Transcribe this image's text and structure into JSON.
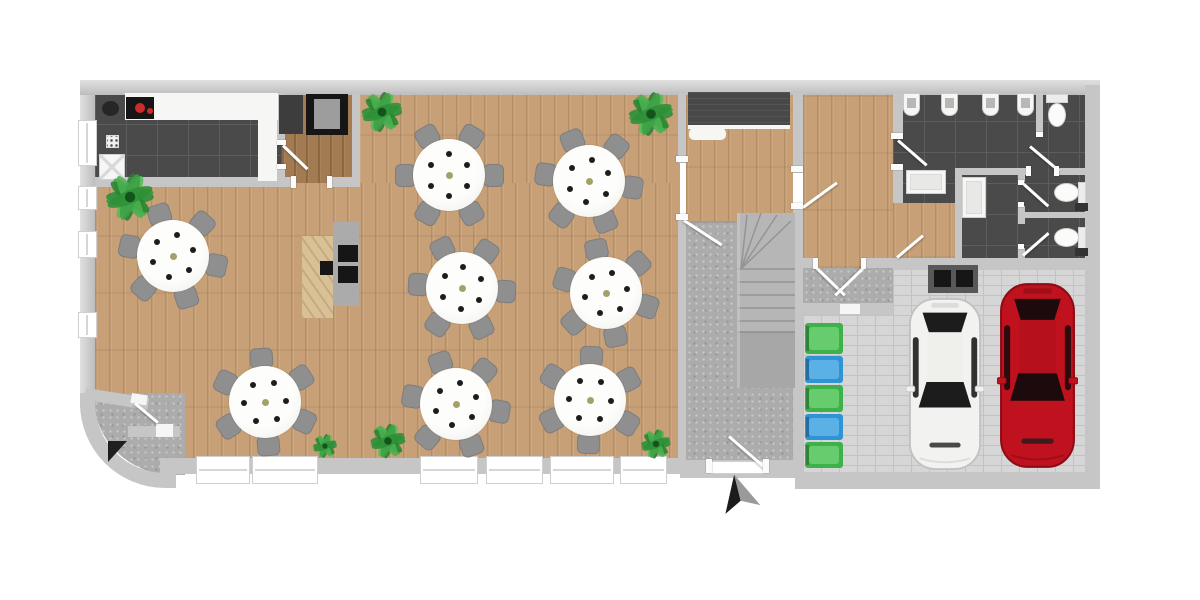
{
  "canvas": {
    "width": 1200,
    "height": 600,
    "background": "#ffffff"
  },
  "palette": {
    "wall": "#c6c6c6",
    "wall_light": "#e0e0e0",
    "wood": "#c7a077",
    "wood_dark": "#a27b52",
    "pine": "#d9c197",
    "tile": "#4a4a4a",
    "tile_line": "#5d5d5d",
    "mat": "#acacac",
    "paver": "#d6d6d6",
    "paver_line": "#c2c2c2",
    "fixture_white": "#f6f6f4",
    "chair": "#8f8f8f",
    "table_white": "#f9f9f6",
    "place_dot": "#1d1d1d",
    "center_dot": "#a3a06a",
    "bin_green": "#3fb14b",
    "bin_blue": "#2f93d4",
    "car_white": "#f2f2f0",
    "car_red": "#c0111e",
    "glass_dark": "#1c1c1c",
    "arrow_dark": "#1c1c1c",
    "arrow_gray": "#9a9a9a"
  },
  "rects": [
    [
      "kitchen-floor",
      "tile",
      95,
      93,
      187,
      90
    ],
    [
      "pantry-floor",
      "woodd",
      282,
      93,
      72,
      92
    ],
    [
      "dining-floor-upper",
      "wood",
      358,
      93,
      322,
      100
    ],
    [
      "dining-floor-main",
      "wood",
      95,
      183,
      585,
      225
    ],
    [
      "dining-floor-south",
      "wood",
      165,
      408,
      515,
      55
    ],
    [
      "vestibule-mat",
      "mat",
      93,
      393,
      92,
      82,
      {
        "br": "0 0 0 80px"
      }
    ],
    [
      "entrance-hall-floor",
      "wood",
      686,
      93,
      107,
      132
    ],
    [
      "floor-transition",
      "gray2",
      686,
      221,
      107,
      3
    ],
    [
      "stair-hall-floor",
      "mat",
      686,
      223,
      107,
      240
    ],
    [
      "corridor-floor",
      "wood",
      803,
      93,
      90,
      175
    ],
    [
      "corridor-landing",
      "mat",
      803,
      268,
      90,
      47
    ],
    [
      "bathroom-floor",
      "tile",
      893,
      90,
      192,
      175
    ],
    [
      "bathroom-wood-hall",
      "wood",
      893,
      203,
      62,
      55
    ],
    [
      "garage-floor-east",
      "paver",
      893,
      265,
      192,
      208
    ],
    [
      "garage-floor-west",
      "paver",
      803,
      315,
      90,
      158
    ],
    [
      "wall-top",
      "wallg",
      80,
      80,
      1020,
      15
    ],
    [
      "wall-left",
      "wallgl",
      80,
      95,
      15,
      313
    ],
    [
      "wall-corner-curve",
      "curve",
      80,
      393,
      96,
      95
    ],
    [
      "wall-bottom-dining",
      "wall",
      160,
      458,
      520,
      16
    ],
    [
      "wall-bottom-stairhall",
      "wall",
      680,
      460,
      121,
      18
    ],
    [
      "wall-bottom-garage",
      "wall",
      795,
      472,
      305,
      17
    ],
    [
      "wall-right",
      "wall",
      1085,
      85,
      15,
      392
    ],
    [
      "wall-kitchen-south",
      "wall",
      95,
      177,
      198,
      10
    ],
    [
      "wall-pantry-south",
      "wall",
      331,
      177,
      29,
      10
    ],
    [
      "wall-kitchen-pantry-upper",
      "wall",
      277,
      93,
      8,
      50
    ],
    [
      "wall-kitchen-pantry-lower",
      "wall",
      277,
      168,
      8,
      19
    ],
    [
      "wall-pantry-dining",
      "wall",
      352,
      93,
      8,
      94
    ],
    [
      "wall-dining-hall-upper",
      "wall",
      678,
      93,
      8,
      70
    ],
    [
      "wall-dining-hall-lower",
      "wall",
      678,
      218,
      8,
      245
    ],
    [
      "wall-hall-corridor-upper",
      "wall",
      793,
      93,
      10,
      80
    ],
    [
      "wall-hall-corridor-lower",
      "wall",
      793,
      207,
      10,
      271
    ],
    [
      "wall-corridor-south-left",
      "wall",
      803,
      258,
      14,
      10
    ],
    [
      "wall-corridor-south-right",
      "wall",
      866,
      258,
      27,
      10
    ],
    [
      "wall-garage-north",
      "wall",
      793,
      303,
      100,
      12
    ],
    [
      "garage-north-door",
      "white",
      840,
      304,
      20,
      10
    ],
    [
      "wall-corridor-bath-upper",
      "wall",
      893,
      93,
      10,
      45
    ],
    [
      "wall-corridor-bath-mid",
      "wall",
      893,
      168,
      10,
      35
    ],
    [
      "wall-bath-south",
      "wall",
      893,
      258,
      192,
      12
    ],
    [
      "wall-bath-h-left",
      "wall",
      955,
      168,
      73,
      7
    ],
    [
      "wall-bath-h-right",
      "wall",
      1058,
      168,
      27,
      7
    ],
    [
      "wall-stall-a-west",
      "wall",
      1036,
      93,
      7,
      43
    ],
    [
      "wall-bath-vertical",
      "wall",
      955,
      175,
      7,
      83
    ],
    [
      "wall-stalls-west-a",
      "wall",
      1018,
      175,
      7,
      7
    ],
    [
      "wall-stalls-west-b",
      "wall",
      1018,
      206,
      7,
      18
    ],
    [
      "wall-stalls-west-c",
      "wall",
      1018,
      248,
      7,
      10
    ],
    [
      "wall-stalls-divider",
      "wall",
      1018,
      212,
      67,
      6
    ],
    [
      "vestibule-wall-angled",
      "wall",
      86,
      388,
      64,
      12,
      {
        "rot": 9
      }
    ],
    [
      "vestibule-door-angled",
      "white",
      132,
      393,
      16,
      10,
      {
        "rot": 9
      }
    ],
    [
      "vestibule-wall-inner",
      "wall",
      128,
      426,
      52,
      11
    ],
    [
      "vestibule-door-inner",
      "white",
      156,
      424,
      17,
      13
    ],
    [
      "kitchen-counter",
      "white",
      125,
      93,
      153,
      27
    ],
    [
      "kitchen-counter-right",
      "white",
      258,
      93,
      19,
      88
    ],
    [
      "kitchen-cooktop",
      "black",
      126,
      97,
      28,
      22
    ],
    [
      "cooktop-knob",
      "red",
      135,
      103,
      10,
      10
    ],
    [
      "cooktop-knob-small",
      "red",
      147,
      108,
      6,
      6
    ],
    [
      "kitchen-sink-unit",
      "blob",
      102,
      101,
      17,
      15
    ],
    [
      "kitchen-dishwasher",
      "dw",
      99,
      154,
      26,
      26
    ],
    [
      "kitchen-switch-panel",
      "sw",
      106,
      135,
      13,
      13
    ],
    [
      "pantry-fridge",
      "dkgray",
      279,
      95,
      24,
      39
    ],
    [
      "pantry-appliance",
      "black",
      306,
      94,
      42,
      41
    ],
    [
      "pantry-appliance-screen",
      "gray2",
      314,
      99,
      26,
      30
    ],
    [
      "bar-counter-wood",
      "pine",
      302,
      236,
      31,
      82
    ],
    [
      "bar-counter-unit",
      "gray3",
      333,
      222,
      26,
      84
    ],
    [
      "bar-screen-top",
      "black",
      338,
      245,
      20,
      17
    ],
    [
      "bar-screen-bottom",
      "black",
      338,
      266,
      20,
      17
    ],
    [
      "bar-register",
      "black",
      320,
      261,
      13,
      14
    ],
    [
      "entrance-mat",
      "darkmat",
      688,
      92,
      102,
      33
    ],
    [
      "entrance-mat-edge",
      "white",
      688,
      125,
      102,
      4
    ],
    [
      "entrance-shelf",
      "white",
      689,
      128,
      37,
      12,
      {
        "br": "5px"
      }
    ],
    [
      "garage-wallbox",
      "gray4",
      928,
      265,
      50,
      28
    ],
    [
      "garage-wallbox-screen-left",
      "black",
      934,
      270,
      17,
      17
    ],
    [
      "garage-wallbox-screen-right",
      "black",
      956,
      270,
      17,
      17
    ]
  ],
  "windows_left": [
    [
      120,
      46
    ],
    [
      186,
      24
    ],
    [
      231,
      27
    ],
    [
      312,
      26
    ]
  ],
  "windows_bottom": [
    [
      196,
      54
    ],
    [
      252,
      66
    ],
    [
      420,
      58
    ],
    [
      486,
      57
    ],
    [
      550,
      64
    ],
    [
      620,
      47
    ]
  ],
  "entry_threshold": [
    710,
    461,
    57,
    13
  ],
  "door_swings": [
    [
      283,
      144,
      34,
      44,
      "pantry-door"
    ],
    [
      684,
      219,
      45,
      33,
      "dining-hall-door"
    ],
    [
      803,
      206,
      42,
      -36,
      "hall-corridor-door"
    ],
    [
      898,
      139,
      38,
      41,
      "mens-room-door"
    ],
    [
      816,
      266,
      40,
      44,
      "corridor-south-door-left"
    ],
    [
      864,
      266,
      40,
      136,
      "corridor-south-door-right"
    ],
    [
      1030,
      145,
      38,
      40,
      "stall-a-door"
    ],
    [
      1023,
      182,
      34,
      42,
      "stall-b-door"
    ],
    [
      1023,
      254,
      34,
      -41,
      "stall-c-door"
    ],
    [
      897,
      256,
      34,
      -40,
      "bath-hall-door"
    ],
    [
      729,
      435,
      48,
      41,
      "main-entrance-door"
    ],
    [
      135,
      402,
      30,
      40,
      "vestibule-door"
    ]
  ],
  "door_posts": [
    [
      291,
      176,
      5,
      12
    ],
    [
      327,
      176,
      5,
      12
    ],
    [
      676,
      156,
      12,
      6
    ],
    [
      676,
      214,
      12,
      6
    ],
    [
      791,
      166,
      12,
      6
    ],
    [
      791,
      203,
      12,
      6
    ],
    [
      891,
      133,
      12,
      6
    ],
    [
      891,
      164,
      12,
      6
    ],
    [
      706,
      459,
      6,
      14
    ],
    [
      763,
      459,
      6,
      14
    ],
    [
      813,
      258,
      5,
      11
    ],
    [
      861,
      258,
      5,
      11
    ],
    [
      1026,
      166,
      5,
      10
    ],
    [
      1054,
      166,
      5,
      10
    ],
    [
      1036,
      132,
      7,
      5
    ],
    [
      277,
      140,
      9,
      5
    ],
    [
      277,
      164,
      9,
      5
    ],
    [
      1018,
      180,
      6,
      5
    ],
    [
      1018,
      202,
      6,
      5
    ],
    [
      1018,
      244,
      6,
      5
    ]
  ],
  "tables": {
    "radius": 36,
    "chair_radius": 44,
    "chairs_per_table": 6,
    "place_settings": 6,
    "positions": [
      [
        173,
        256,
        12
      ],
      [
        449,
        175,
        0
      ],
      [
        589,
        181,
        8
      ],
      [
        462,
        288,
        4
      ],
      [
        606,
        293,
        18
      ],
      [
        265,
        402,
        26
      ],
      [
        456,
        404,
        10
      ],
      [
        590,
        400,
        32
      ]
    ]
  },
  "plants": [
    [
      130,
      197,
      26
    ],
    [
      382,
      112,
      22
    ],
    [
      651,
      114,
      24
    ],
    [
      325,
      446,
      13
    ],
    [
      388,
      441,
      19
    ],
    [
      656,
      444,
      16
    ]
  ],
  "bins": {
    "x": 805,
    "w": 38,
    "items": [
      [
        323,
        31,
        "green"
      ],
      [
        356,
        27,
        "blue"
      ],
      [
        385,
        27,
        "green"
      ],
      [
        414,
        26,
        "blue"
      ],
      [
        442,
        26,
        "green"
      ]
    ]
  },
  "urinals": {
    "y": 93,
    "w": 17,
    "h": 23,
    "xs": [
      903,
      941,
      982,
      1017
    ]
  },
  "toilets": [
    {
      "dir": "down",
      "x": 1046,
      "y": 94
    },
    {
      "dir": "left",
      "x": 1054,
      "y": 182
    },
    {
      "dir": "left",
      "x": 1054,
      "y": 227
    }
  ],
  "vanities": [
    [
      906,
      170,
      40,
      24
    ],
    [
      962,
      177,
      24,
      41
    ]
  ],
  "cars": [
    {
      "color": "white",
      "x": 906,
      "y": 296,
      "w": 78,
      "h": 176
    },
    {
      "color": "red",
      "x": 997,
      "y": 281,
      "w": 81,
      "h": 189
    }
  ],
  "stairs": {
    "x": 737,
    "y": 213,
    "w": 58,
    "h": 175
  },
  "north_arrow": {
    "x": 713,
    "y": 474,
    "w": 52,
    "h": 40,
    "rotation": -14
  },
  "dark_wedge": {
    "x": 108,
    "y": 441
  }
}
